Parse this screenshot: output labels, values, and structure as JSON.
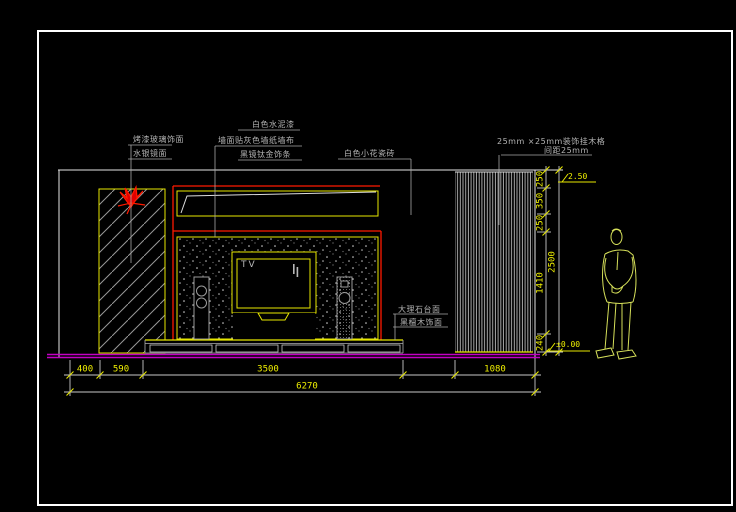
{
  "drawing_labels": {
    "left_panel": [
      "烤漆玻璃饰面",
      "水银镜面"
    ],
    "wall_top": [
      "白色水泥漆",
      "墙面贴灰色墙纸墙布",
      "黑镜钛金饰条"
    ],
    "wall_right": "白色小花瓷砖",
    "grille": [
      "25mm ×25mm装饰挂木格",
      "间距25mm"
    ],
    "cabinet": [
      "大理石台面",
      "黑檀木饰面"
    ],
    "tv": "TV"
  },
  "dimensions": {
    "bottom_segments": [
      "400",
      "590",
      "3500",
      "1080"
    ],
    "bottom_total": "6270",
    "right_segments": [
      "250",
      "350",
      "250",
      "1410",
      "240"
    ],
    "right_total": "2500",
    "elevation_top": "2.50",
    "elevation_bottom": "±0.00"
  },
  "colors": {
    "background": "#000000",
    "frame": "#ffffff",
    "dimension_text": "#f0f000",
    "outline_yellow": "#e8e800",
    "accent_red": "#ff1a00",
    "floor_magenta": "#c400c4",
    "label_gray": "#b4b4b4",
    "figure_green": "#d6e05a"
  }
}
